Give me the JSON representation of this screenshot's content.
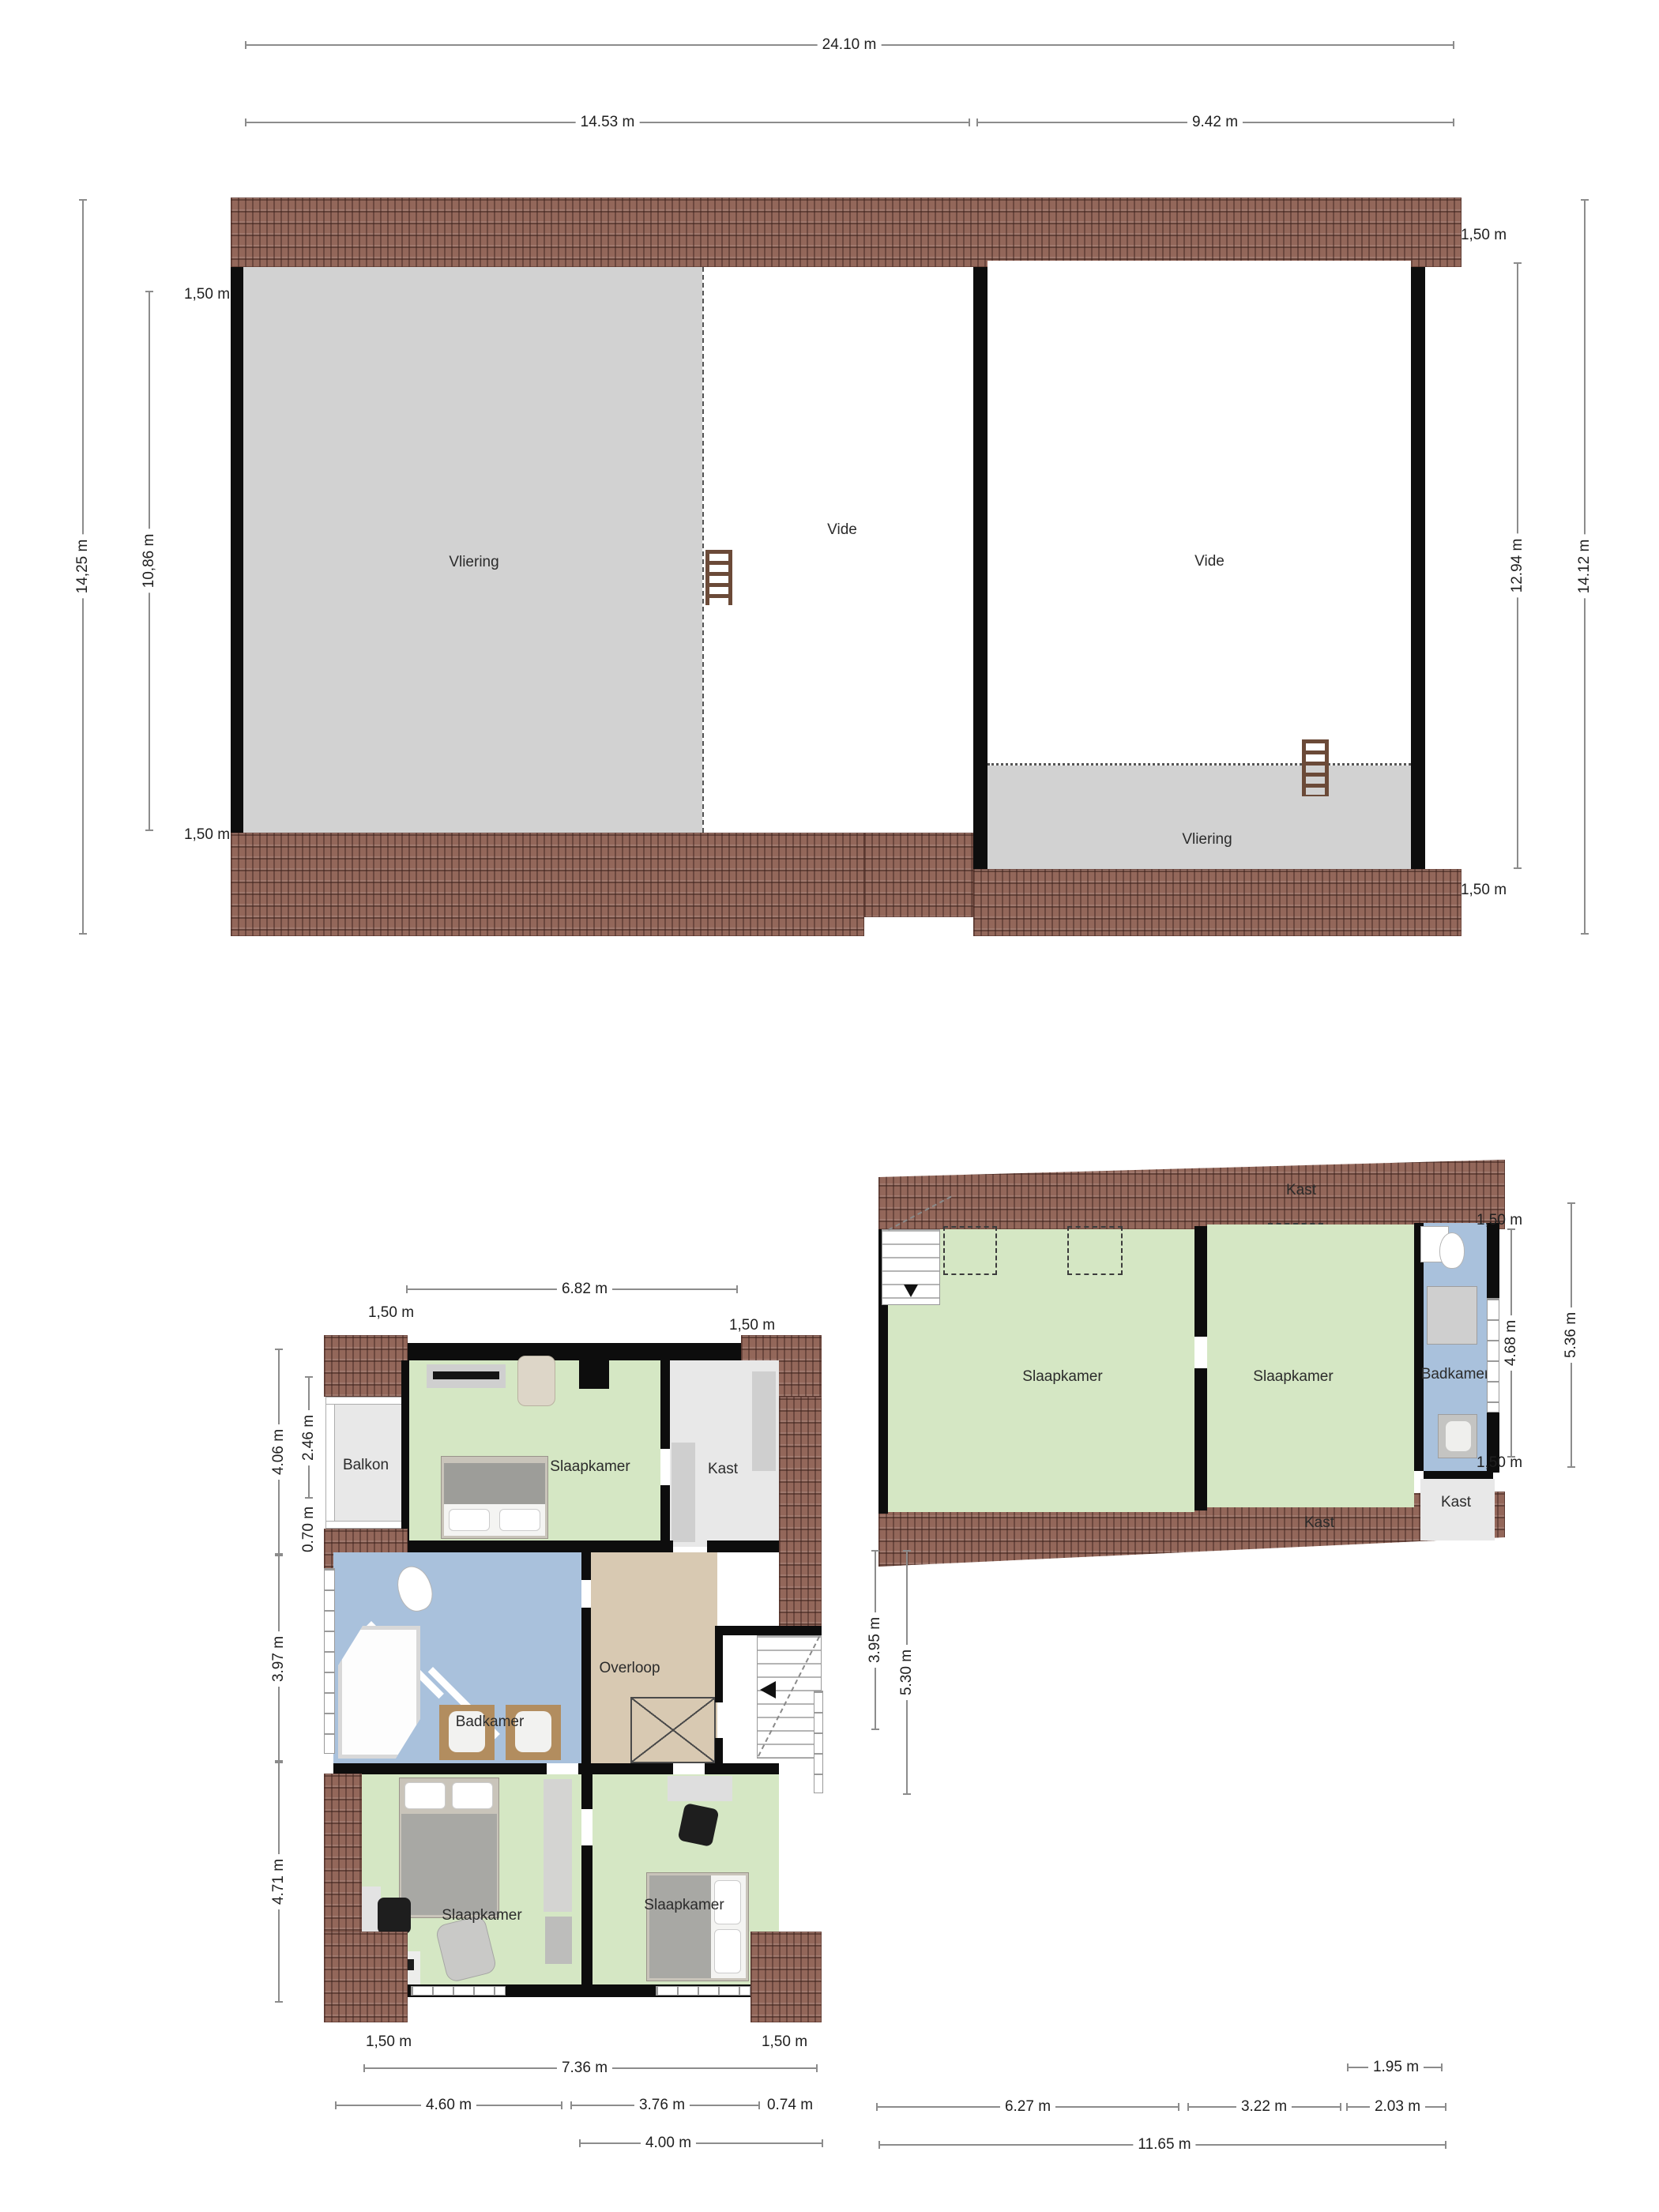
{
  "colors": {
    "roof": "#93675a",
    "wall": "#0d0d0d",
    "room_green": "#d5e7c4",
    "room_blue": "#a9c1dc",
    "room_tan": "#d8c9b2",
    "room_light_grey": "#e8e8e8",
    "vliering_grey": "#d2d2d2",
    "dim_line": "#8c8c8c"
  },
  "attic": {
    "dims": {
      "w_total": "24.10 m",
      "w_left": "14.53 m",
      "w_right": "9.42 m",
      "h_left_outer": "14,25 m",
      "h_left_inner": "10,86 m",
      "eave_top_left": "1,50 m",
      "eave_bottom_left": "1,50 m",
      "eave_top_right": "1,50 m",
      "h_right_inner": "12.94 m",
      "h_right_outer": "14.12 m",
      "eave_bottom_right": "1,50 m"
    },
    "rooms": {
      "vliering_left": "Vliering",
      "vide_left": "Vide",
      "vide_right": "Vide",
      "vliering_right": "Vliering"
    }
  },
  "floor1": {
    "dims": {
      "top": "6.82 m",
      "eave_top_left": "1,50 m",
      "eave_top_right": "1,50 m",
      "left_outer_top": "4.06 m",
      "left_inner_top": "2.46 m",
      "left_inner_small": "0.70 m",
      "left_mid": "3.97 m",
      "left_bottom": "4.71 m",
      "eave_bottom_left": "1,50 m",
      "eave_bottom_right": "1,50 m",
      "bottom_total": "7.36 m",
      "bottom_a": "4.60 m",
      "bottom_b": "3.76 m",
      "bottom_c": "0.74 m",
      "bottom_d": "4.00 m"
    },
    "rooms": {
      "balkon": "Balkon",
      "slaapkamer_top": "Slaapkamer",
      "kast_top": "Kast",
      "kast_left": "Kast",
      "badkamer": "Badkamer",
      "overloop": "Overloop",
      "vide": "Vide",
      "slaapkamer_left": "Slaapkamer",
      "slaapkamer_right": "Slaapkamer"
    }
  },
  "floor2": {
    "dims": {
      "eave_top_right": "1,50 m",
      "right_inner": "4.68 m",
      "right_outer": "5.36 m",
      "eave_bottom_right": "1,50 m",
      "left_inner": "3.95 m",
      "left_outer": "5.30 m",
      "bottom_a": "1.95 m",
      "bottom_b": "6.27 m",
      "bottom_c": "3.22 m",
      "bottom_d": "2.03 m",
      "bottom_total": "11.65 m"
    },
    "rooms": {
      "kast_roof_top": "Kast",
      "slaapkamer_left": "Slaapkamer",
      "slaapkamer_right": "Slaapkamer",
      "badkamer": "Badkamer",
      "kast_mid": "Kast",
      "kast_roof_bottom": "Kast"
    }
  }
}
